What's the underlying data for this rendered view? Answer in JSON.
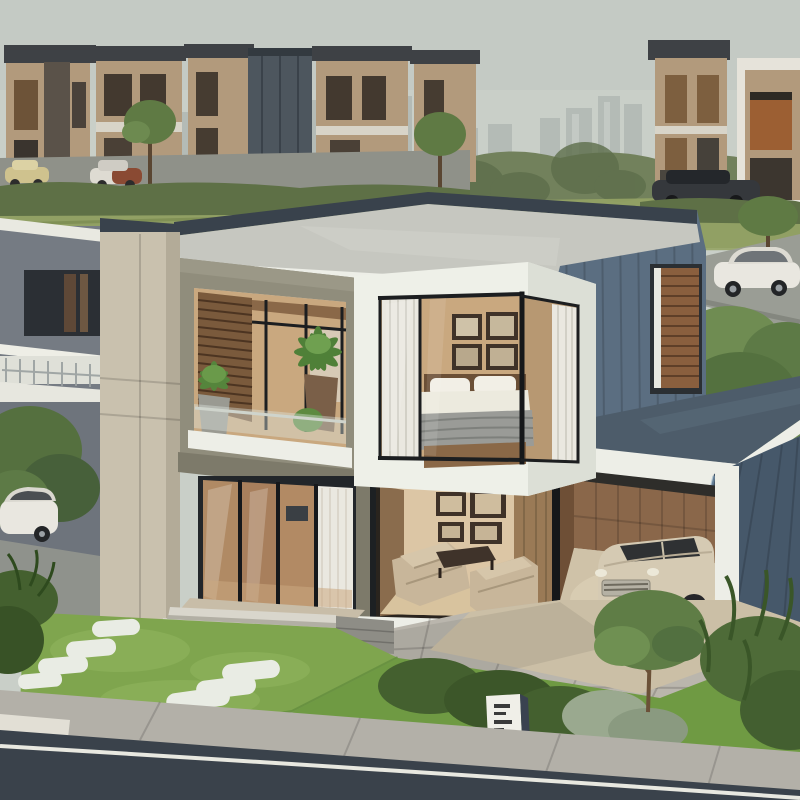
{
  "scene": {
    "description": "Photorealistic daytime rendering of a modern two-storey cubic house with open carport, glass facades, front lawn with stepping stones, driveway, and a suburban row of boxy houses with a city skyline behind",
    "address_sign": {
      "text_legible": false
    }
  },
  "objects": [
    "city-skyline",
    "background-houses",
    "street-cars",
    "main-house",
    "flat-roof",
    "balcony-with-plants",
    "bedroom-corner-window",
    "living-room",
    "glass-sliding-doors",
    "carport",
    "parked-cream-car",
    "white-sedan",
    "front-lawn",
    "stepping-stones",
    "entry-steps",
    "driveway",
    "garden-bushes",
    "small-tree",
    "address-sign",
    "road"
  ],
  "colors": {
    "sky": "#c9cfc8",
    "skyline": "#aeb5b1",
    "treeline": "#72815c",
    "field": "#95a365",
    "hedge": "#5e7046",
    "bg_house_tan": "#b29a7c",
    "bg_house_dark": "#3e4145",
    "bg_glass": "#4d565e",
    "bg_road": "#8f9189",
    "road_right": "#9a9d95",
    "neighbor_wall": "#757b83",
    "neighbor_white": "#e9e9e1",
    "column_beige": "#c9c1ae",
    "roof_top": "#c6c7c0",
    "parapet": "#39424c",
    "fascia_white": "#edeee7",
    "wing_blue": "#5b6e81",
    "carport_roof": "#4d5c6a",
    "dark_wall": "#46586a",
    "olive_wall": "#908d7c",
    "olive_dark": "#7d7a6a",
    "interior_warm": "#c9a87f",
    "wood_slat": "#7a5a3c",
    "box_white": "#eef0e8",
    "box_side": "#dcdfd6",
    "curtain": "#eae8e0",
    "bed_white": "#eceade",
    "blanket_gray": "#9a9b97",
    "headboard": "#6b4f36",
    "glass_warm": "#b08a64",
    "living_back": "#dcc6a5",
    "sofa": "#c8b69a",
    "floor_wood": "#d8c39e",
    "frame_dark": "#3f3228",
    "carport_wood": "#8a674a",
    "carport_floor": "#cfc2a8",
    "car_cream": "#d5cab3",
    "car_white": "#e9e7e0",
    "car_suv": "#35383c",
    "car_rust": "#8a4a33",
    "car_yellow": "#cfc28e",
    "louver": "#8a5f3e",
    "lawn": "#7fa54e",
    "bush_dark": "#44602f",
    "bush_light": "#6f8c52",
    "bush_silver": "#9aa98f",
    "stone": "#e9ece4",
    "paver": "#bab6ad",
    "path_beige": "#cbbfa6",
    "sidewalk": "#b3b0a8",
    "road": "#3a424b",
    "road_line": "#e8e8e0",
    "sign_white": "#f0efe8",
    "mullion": "#1c1e20"
  }
}
